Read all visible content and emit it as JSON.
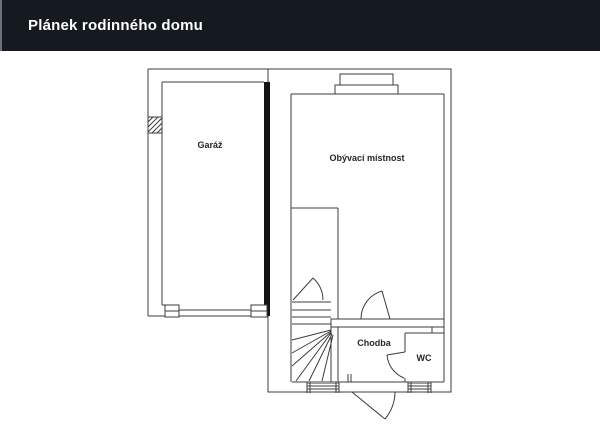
{
  "header": {
    "title": "Plánek rodinného domu"
  },
  "plan": {
    "rooms": [
      {
        "id": "garaz",
        "label": "Garáž"
      },
      {
        "id": "obyvaci-mistnost",
        "label": "Obývací místnost"
      },
      {
        "id": "chodba",
        "label": "Chodba"
      },
      {
        "id": "wc",
        "label": "WC"
      }
    ],
    "features": [
      "staircase-with-winders",
      "entrance-door",
      "interior-doors",
      "windows",
      "garage-door",
      "wall-hatch"
    ],
    "colors": {
      "header_bg": "#151a21",
      "header_text": "#ffffff",
      "wall_line": "#3c3c3c",
      "thick_wall": "#141414",
      "background": "#ffffff"
    }
  }
}
